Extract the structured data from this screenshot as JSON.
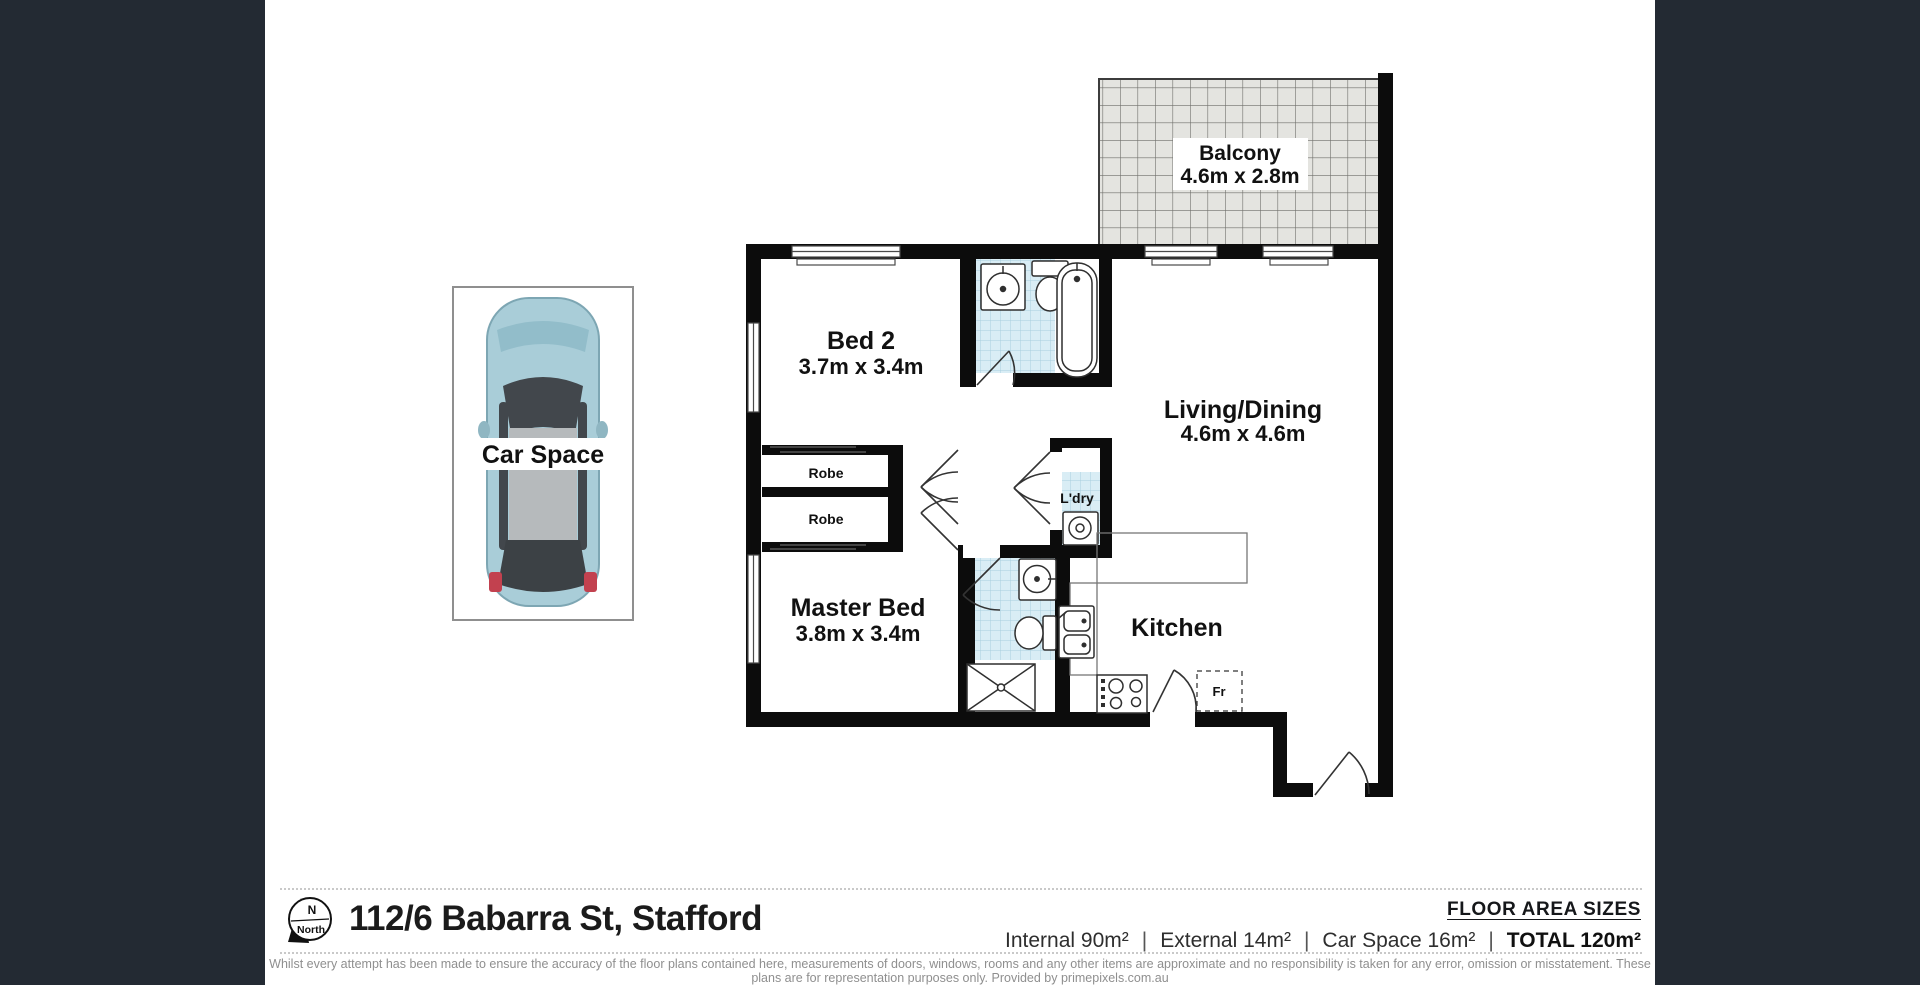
{
  "colors": {
    "side_panel": "#232a33",
    "paper": "#ffffff",
    "wall": "#0c0c0c",
    "tile_blue": "#d9edf5",
    "tile_blue_line": "#a9cede",
    "balcony_tile": "#e4e4e0",
    "car_body": "#a9cdd8",
    "disclaimer_text": "#8f8f8f"
  },
  "rooms": {
    "balcony": {
      "name": "Balcony",
      "dims": "4.6m x 2.8m"
    },
    "bed2": {
      "name": "Bed 2",
      "dims": "3.7m x 3.4m"
    },
    "living": {
      "name": "Living/Dining",
      "dims": "4.6m x 4.6m"
    },
    "master": {
      "name": "Master Bed",
      "dims": "3.8m x 3.4m"
    },
    "kitchen": {
      "name": "Kitchen"
    },
    "laundry": {
      "name": "L'dry"
    },
    "robe_top": {
      "name": "Robe"
    },
    "robe_bottom": {
      "name": "Robe"
    },
    "car_space": {
      "name": "Car Space"
    },
    "fridge": {
      "name": "Fr"
    }
  },
  "footer": {
    "north": {
      "letter": "N",
      "word": "North"
    },
    "address": "112/6 Babarra St, Stafford",
    "floor_area_title": "FLOOR AREA SIZES",
    "areas": {
      "internal": "Internal 90m²",
      "external": "External 14m²",
      "car_space": "Car Space 16m²",
      "total": "TOTAL 120m²"
    },
    "separator": "|",
    "disclaimer": "Whilst every attempt has been made to ensure the accuracy of the floor plans contained here, measurements of doors, windows, rooms and any other items are approximate and no responsibility is taken for any error, omission or misstatement. These plans are for representation purposes only. Provided by primepixels.com.au"
  }
}
